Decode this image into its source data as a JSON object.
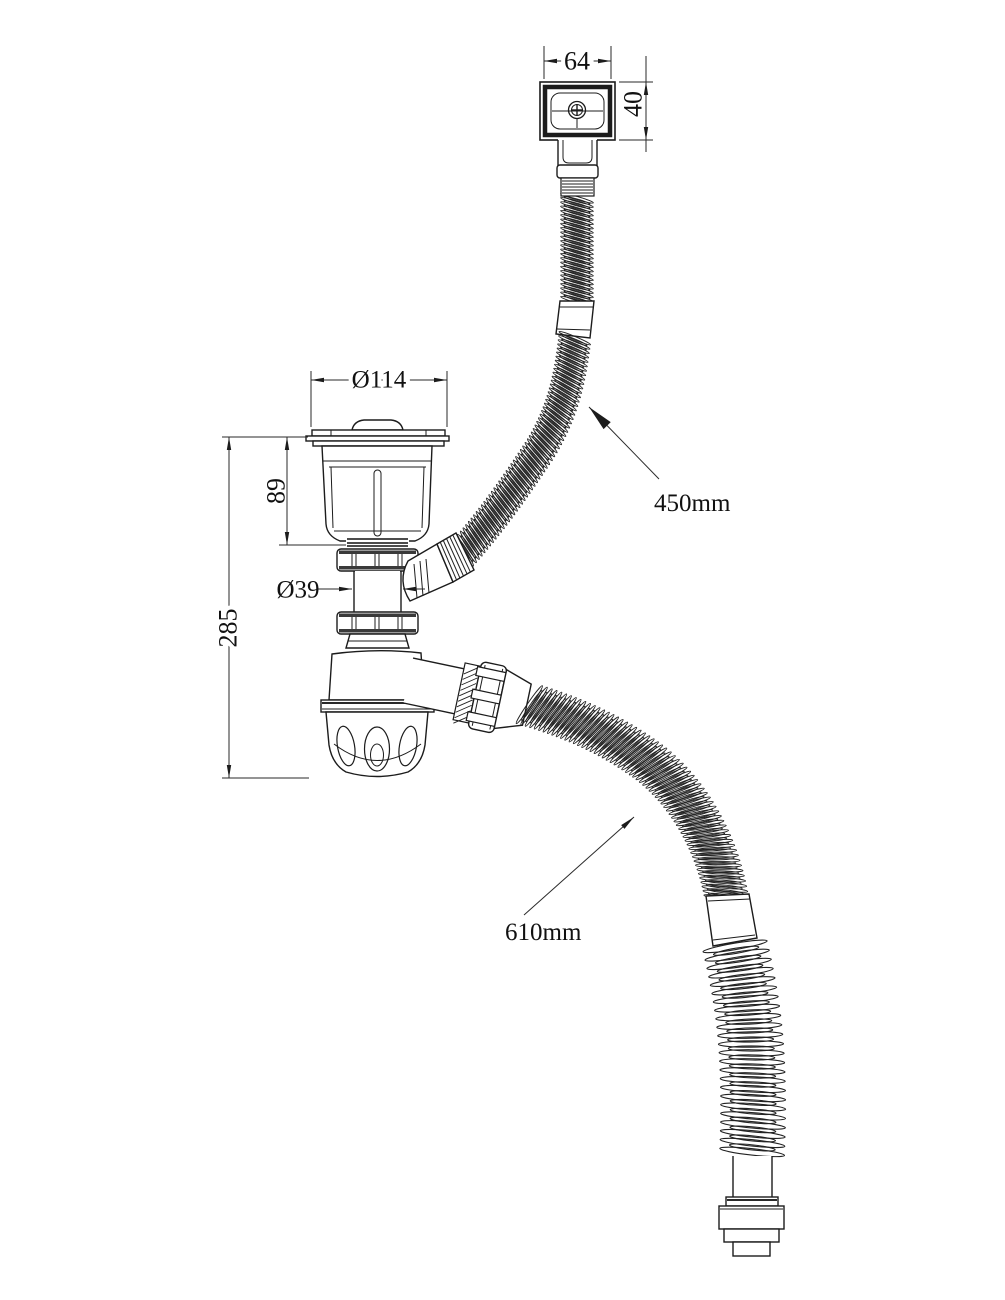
{
  "drawing": {
    "labels": {
      "overflow_width": "64",
      "overflow_height": "40",
      "strainer_flange_diameter": "Ø114",
      "strainer_body_height": "89",
      "tailpipe_diameter": "Ø39",
      "assembly_height": "285",
      "overflow_hose_length": "450mm",
      "waste_hose_length": "610mm"
    },
    "colors": {
      "line": "#1c1c1c",
      "background": "#ffffff"
    }
  }
}
